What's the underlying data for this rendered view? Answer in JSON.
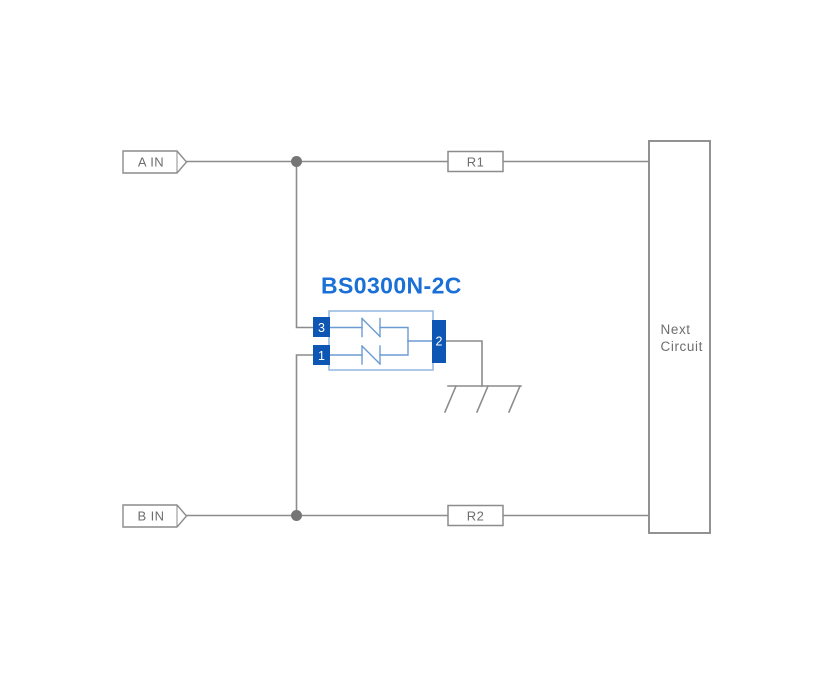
{
  "ports": {
    "a_in": "A IN",
    "b_in": "B IN"
  },
  "resistors": {
    "r1": "R1",
    "r2": "R2"
  },
  "component": {
    "name": "BS0300N-2C",
    "pins": {
      "top_left": "3",
      "bottom_left": "1",
      "right": "2"
    }
  },
  "next_circuit": {
    "line1": "Next",
    "line2": "Circuit"
  },
  "colors": {
    "background": "#ffffff",
    "wire": "#8c8c8c",
    "junction_dot": "#757575",
    "label_text": "#6e6e6e",
    "component_title_blue": "#1a70d6",
    "pin_fill_blue": "#0e56b4",
    "pin_text": "#ffffff",
    "component_outline_blue": "#93b7e0",
    "diode_symbol_blue": "#6b9bd2"
  }
}
